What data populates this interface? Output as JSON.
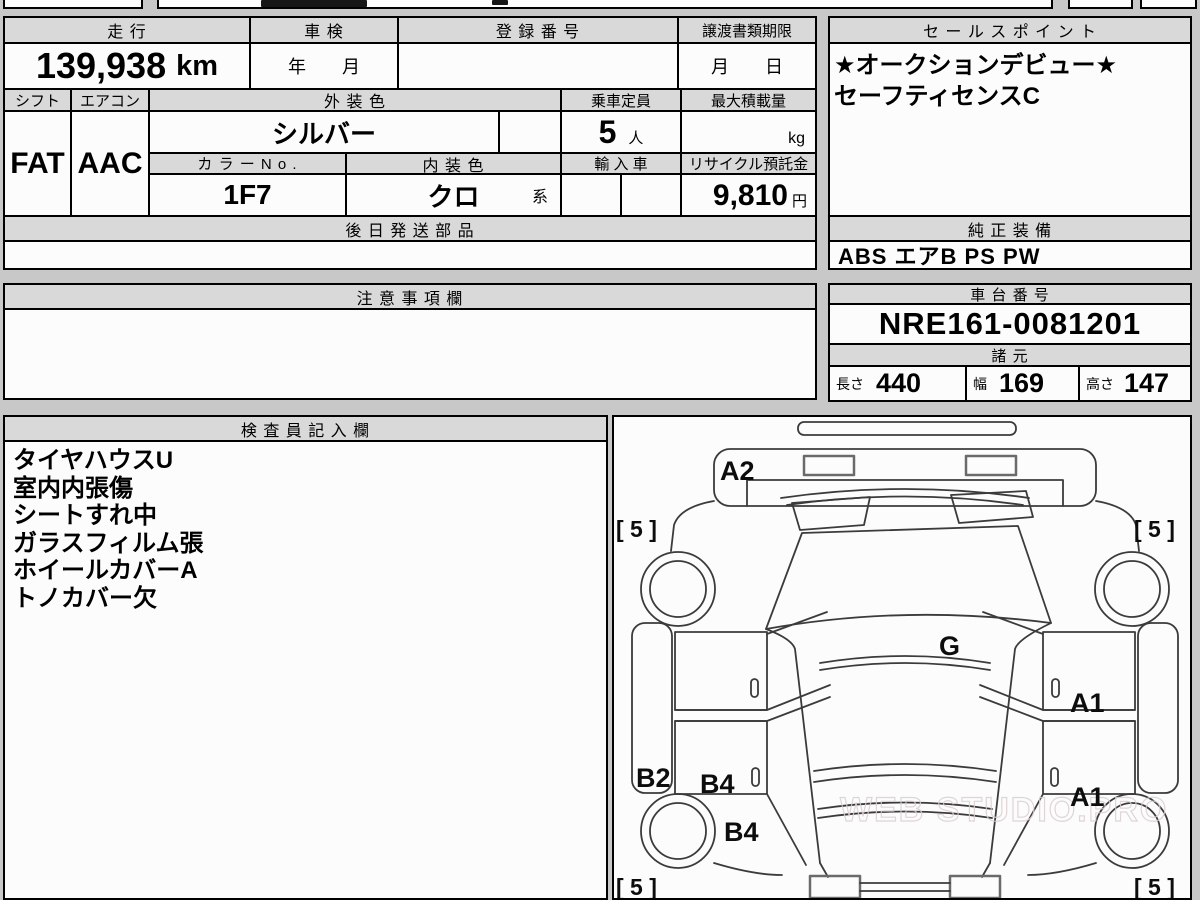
{
  "colors": {
    "page_bg": "#c8c8c8",
    "header_bg": "#d9d9d9",
    "border": "#000000",
    "line": "#3b3b3b"
  },
  "table": {
    "mileage": {
      "label": "走 行",
      "value": "139,938",
      "unit": "km"
    },
    "inspection": {
      "label": "車 検",
      "value": "年　　月"
    },
    "registration": {
      "label": "登 録 番 号",
      "value": ""
    },
    "transfer_deadline": {
      "label": "譲渡書類期限",
      "value": "月　　日"
    },
    "shift": {
      "label": "シフト",
      "value": "FAT"
    },
    "aircon": {
      "label": "エアコン",
      "value": "AAC"
    },
    "exterior_color": {
      "label": "外 装 色",
      "value": "シルバー"
    },
    "capacity": {
      "label": "乗車定員",
      "value": "5",
      "unit": "人"
    },
    "max_load": {
      "label": "最大積載量",
      "value": "",
      "unit": "kg"
    },
    "color_no": {
      "label": "カ ラ ー N o .",
      "value": "1F7"
    },
    "interior_color": {
      "label": "内 装 色",
      "value": "クロ",
      "suffix": "系"
    },
    "imported": {
      "label": "輸 入 車",
      "value": ""
    },
    "recycle_deposit": {
      "label": "リサイクル預託金",
      "value": "9,810",
      "unit": "円"
    },
    "later_shipped_parts": {
      "label": "後 日 発 送 部 品",
      "value": ""
    }
  },
  "sales_point": {
    "label": "セ ー ル ス ポ イ ン ト",
    "lines": [
      "★オークションデビュー★",
      "セーフティセンスC"
    ]
  },
  "genuine_equipment": {
    "label": "純 正 装 備",
    "value": "ABS エアB PS PW"
  },
  "notes": {
    "label": "注 意 事 項 欄",
    "value": ""
  },
  "chassis_no": {
    "label": "車 台 番 号",
    "value": "NRE161-0081201"
  },
  "specs": {
    "label": "諸 元",
    "length_label": "長さ",
    "length": "440",
    "width_label": "幅",
    "width": "169",
    "height_label": "高さ",
    "height": "147"
  },
  "inspector_notes": {
    "label": "検 査 員 記 入 欄",
    "lines": [
      "タイヤハウスU",
      "室内内張傷",
      "シートすれ中",
      "ガラスフィルム張",
      "ホイールカバーA",
      "トノカバー欠"
    ]
  },
  "diagram": {
    "damage_labels": {
      "front_bumper": "A2",
      "glass": "G",
      "right_front_door": "A1",
      "right_rear_fender": "A1",
      "left_sill": "B2",
      "left_rear_door": "B4",
      "left_rear_fender": "B4"
    },
    "tire_labels": {
      "front_left": "[ 5 ]",
      "front_right": "[ 5 ]",
      "rear_left": "[ 5 ]",
      "rear_right": "[ 5 ]"
    },
    "watermark": "WEB STUDIO.PRO"
  }
}
